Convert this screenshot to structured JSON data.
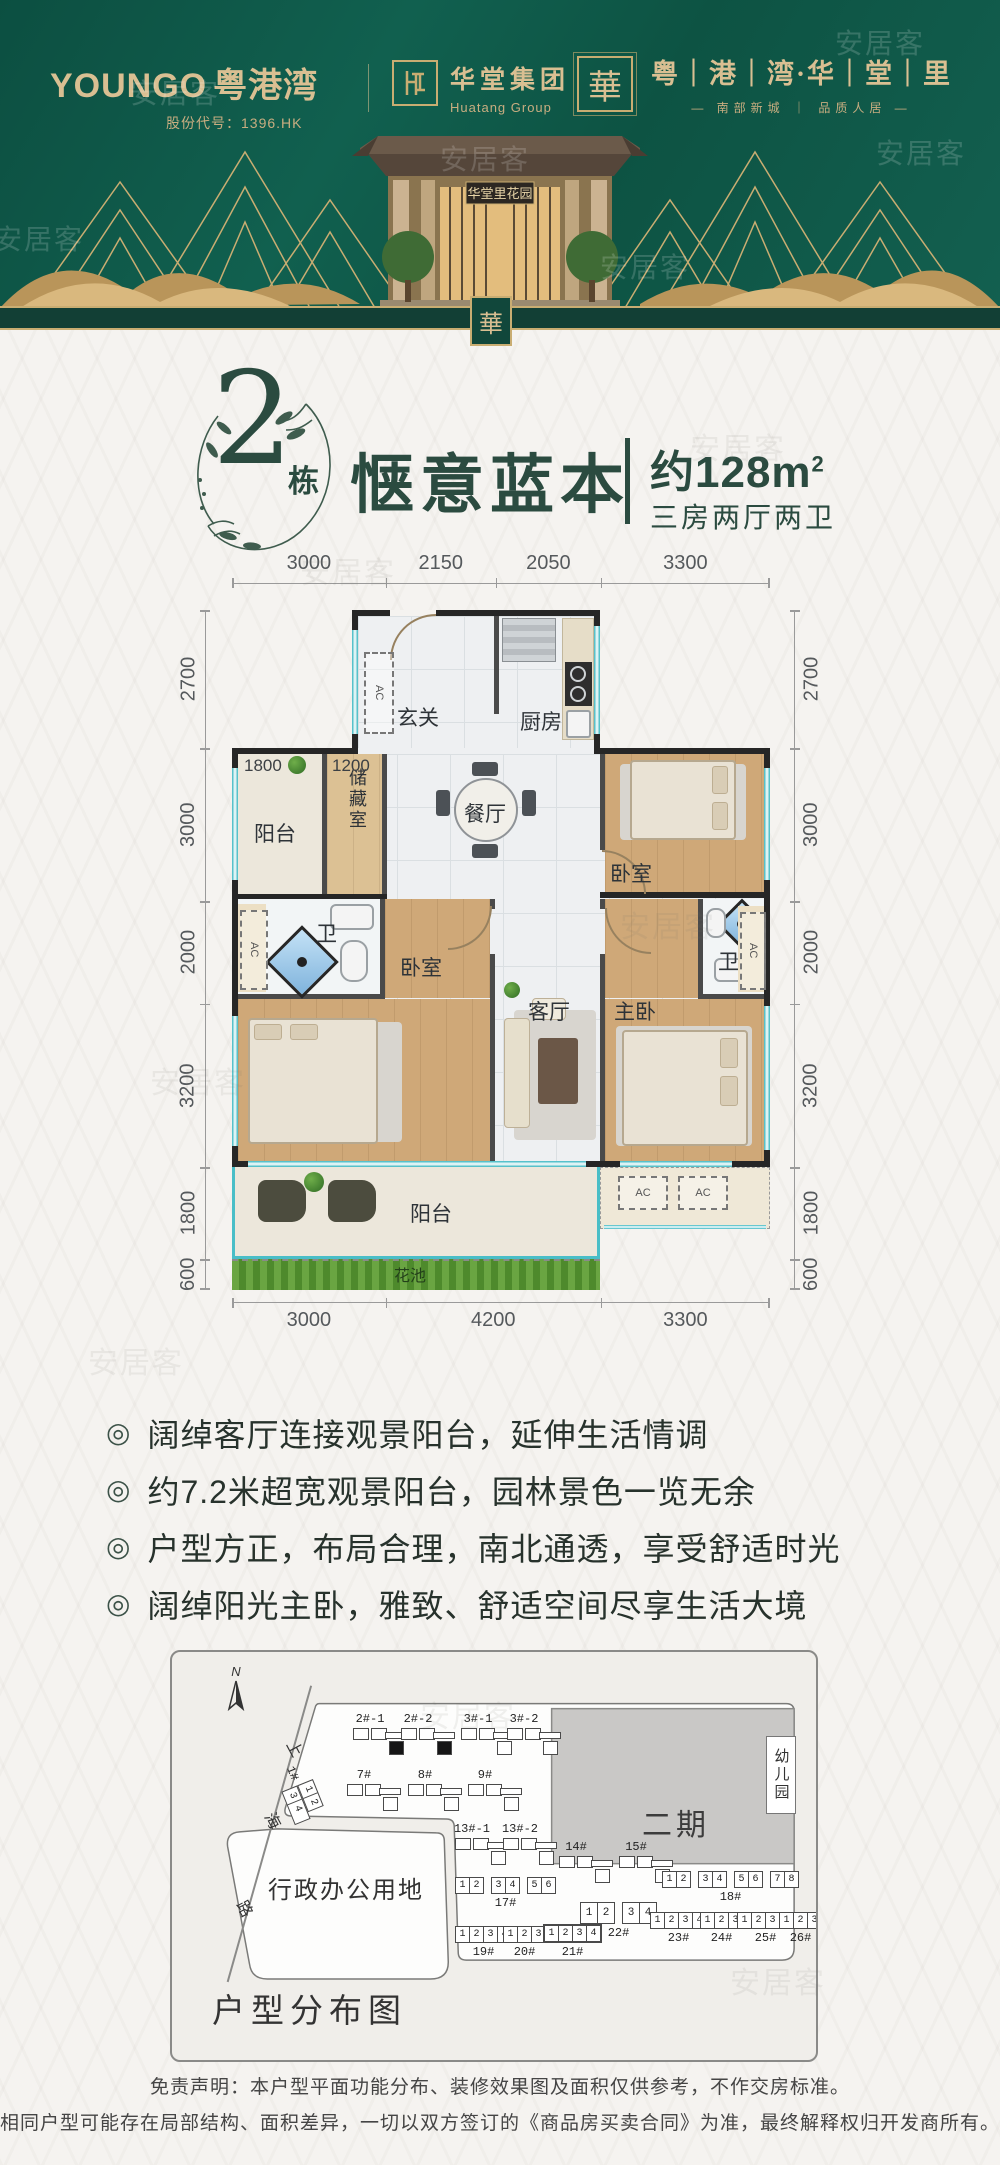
{
  "watermark": "安居客",
  "header": {
    "brand_left": {
      "logo": "YOUNGO",
      "name": "粤港湾",
      "stock": "股份代号：1396.HK"
    },
    "brand_mid": {
      "name": "华堂集团",
      "sub": "Huatang Group"
    },
    "brand_right": {
      "seal": "華",
      "name": "粤｜港｜湾·华｜堂｜里",
      "slogan": "— 南部新城 ｜ 品质人居 —"
    },
    "gate_sign": "华堂里花园",
    "pendant": "華"
  },
  "title": {
    "block_number": "2",
    "block_unit": "栋",
    "name": "惬意蓝本",
    "area_text": "约128m",
    "area_sup": "2",
    "layout": "三房两厅两卫"
  },
  "floor_plan": {
    "dims_top": [
      "3000",
      "2150",
      "2050",
      "3300"
    ],
    "dims_bottom": [
      "3000",
      "4200",
      "3300"
    ],
    "dims_left": [
      "2700",
      "3000",
      "2000",
      "3200",
      "1800",
      "600"
    ],
    "dims_right": [
      "2700",
      "3000",
      "2000",
      "3200",
      "1800",
      "600"
    ],
    "inner_dims": [
      "1800",
      "1200"
    ],
    "rooms": {
      "entry": "玄关",
      "kitchen": "厨房",
      "balcony_top": "阳台",
      "storage": "储藏室",
      "dining": "餐厅",
      "bedroom_ne": "卧室",
      "bath_left": "卫",
      "bedroom_sw": "卧室",
      "living": "客厅",
      "master": "主卧",
      "bath_right": "卫",
      "balcony_bottom": "阳台",
      "flower_bed": "花池"
    },
    "ac_label": "AC"
  },
  "bullet_glyph": "◎",
  "highlights": [
    "阔绰客厅连接观景阳台，延伸生活情调",
    "约7.2米超宽观景阳台，园林景色一览无余",
    "户型方正，布局合理，南北通透，享受舒适时光",
    "阔绰阳光主卧，雅致、舒适空间尽享生活大境"
  ],
  "site_plan": {
    "caption": "户型分布图",
    "north": "N",
    "road": [
      "上",
      "海",
      "路"
    ],
    "admin_area": "行政办公用地",
    "phase2": "二期",
    "kindergarten": "幼儿园",
    "buildings": [
      {
        "name": "1#",
        "cells": [
          [
            "1",
            "2"
          ],
          [
            "3",
            "4"
          ]
        ]
      },
      {
        "name": "2#-1",
        "highlight": true
      },
      {
        "name": "2#-2",
        "highlight": true
      },
      {
        "name": "3#-1"
      },
      {
        "name": "3#-2"
      },
      {
        "name": "7#"
      },
      {
        "name": "8#"
      },
      {
        "name": "9#"
      },
      {
        "name": "13#-1"
      },
      {
        "name": "13#-2"
      },
      {
        "name": "14#"
      },
      {
        "name": "15#"
      }
    ],
    "strips": [
      {
        "name": "17#",
        "cells": [
          [
            "1",
            "2"
          ],
          [
            "3",
            "4"
          ],
          [
            "5",
            "6"
          ]
        ]
      },
      {
        "name": "18#",
        "cells": [
          [
            "1",
            "2"
          ],
          [
            "3",
            "4"
          ],
          [
            "5",
            "6"
          ],
          [
            "7",
            "8"
          ]
        ]
      },
      {
        "name": "19#",
        "cells": [
          "1",
          "2",
          "3",
          "4"
        ]
      },
      {
        "name": "20#",
        "cells": [
          "1",
          "2",
          "3"
        ]
      },
      {
        "name": "21#",
        "cells": [
          "1",
          "2",
          "3",
          "4"
        ]
      },
      {
        "name": "22#",
        "cells": [
          [
            "1",
            "2"
          ],
          [
            "3",
            "4"
          ]
        ]
      },
      {
        "name": "23#",
        "cells": [
          "1",
          "2",
          "3",
          "4"
        ]
      },
      {
        "name": "24#",
        "cells": [
          "1",
          "2",
          "3"
        ]
      },
      {
        "name": "25#",
        "cells": [
          "1",
          "2",
          "3",
          "4"
        ]
      },
      {
        "name": "26#",
        "cells": [
          "1",
          "2",
          "3"
        ]
      }
    ]
  },
  "disclaimer": [
    "免责声明：本户型平面功能分布、装修效果图及面积仅供参考，不作交房标准。",
    "相同户型可能存在局部结构、面积差异，一切以双方签订的《商品房买卖合同》为准，最终解释权归开发商所有。"
  ]
}
